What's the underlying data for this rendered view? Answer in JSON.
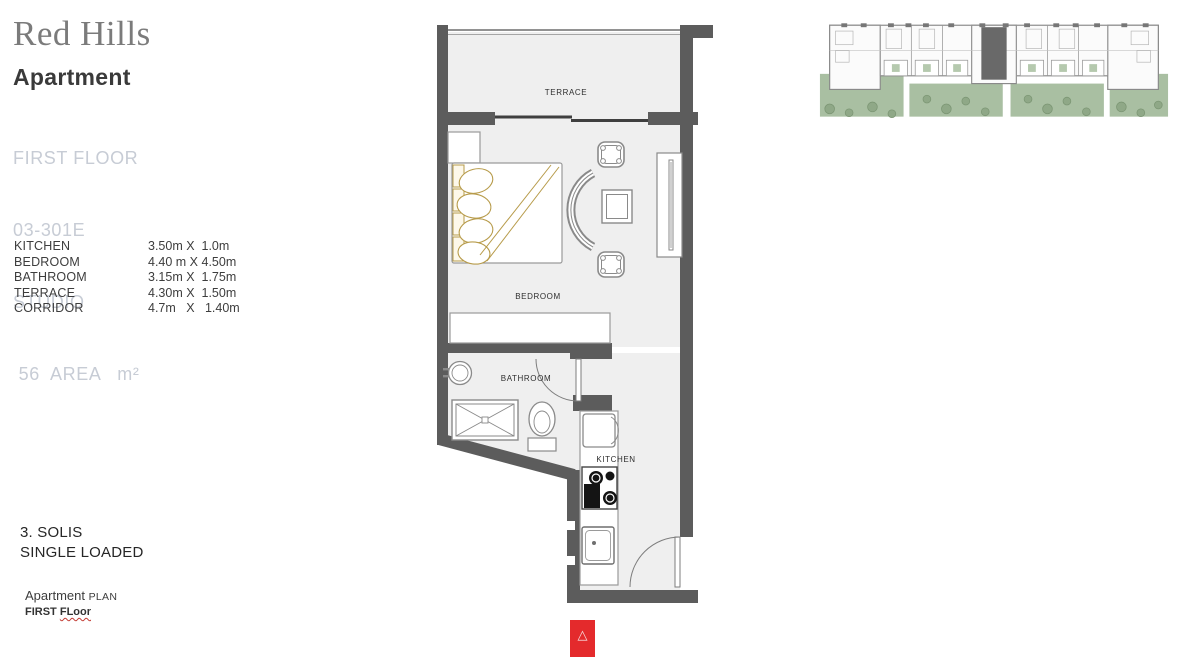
{
  "brand": {
    "name": "Red Hills"
  },
  "sidebar": {
    "title": "Apartment",
    "floor": "FIRST FLOOR",
    "unit_number": "03-301E",
    "unit_type": "STUDIO",
    "area_line": " 56  AREA   m²"
  },
  "dimensions": [
    {
      "room": "KITCHEN",
      "size": "3.50m X  1.0m"
    },
    {
      "room": "BEDROOM",
      "size": "4.40 m X 4.50m"
    },
    {
      "room": "BATHROOM",
      "size": "3.15m X  1.75m"
    },
    {
      "room": "TERRACE",
      "size": "4.30m X  1.50m"
    },
    {
      "room": "CORRIDOR",
      "size": "4.7m   X   1.40m"
    }
  ],
  "project": {
    "name": "3. SOLIS",
    "loading": "SINGLE LOADED",
    "caption_word": "Apartment ",
    "caption_small": "PLAN",
    "floor_prefix": "FIRST ",
    "floor_word": "FLoor"
  },
  "plan": {
    "labels": {
      "terrace": "TERRACE",
      "bedroom": "BEDROOM",
      "bathroom": "BATHROOM",
      "kitchen": "KITCHEN"
    }
  },
  "marker": {
    "glyph": "△"
  },
  "colors": {
    "wall": "#5c5c5c",
    "floor": "#efefef",
    "furniture_outline": "#8a8a8a",
    "bed_gold": "#b79b4a",
    "accent_red": "#e42a2c",
    "landscape_green": "#a9bfa2",
    "muted_label": "#c7ccd5"
  }
}
